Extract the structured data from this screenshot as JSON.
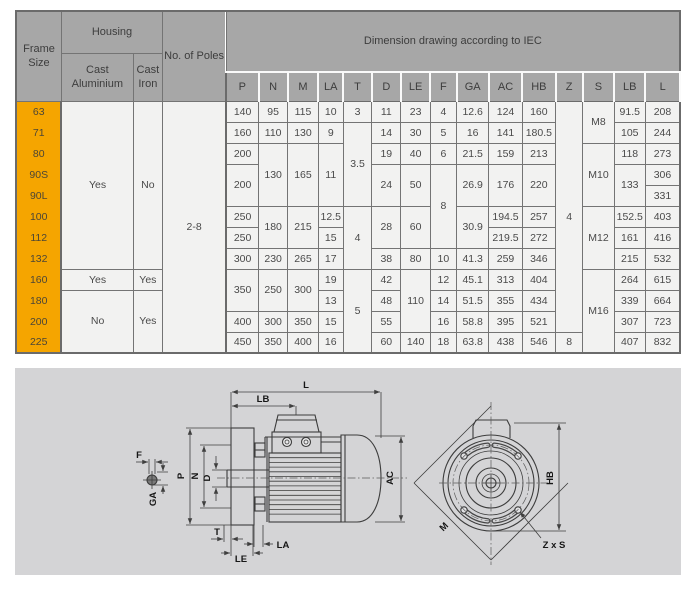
{
  "table": {
    "header": {
      "frame_size": "Frame Size",
      "housing": "Housing",
      "cast_aluminium": "Cast Aluminium",
      "cast_iron": "Cast Iron",
      "poles": "No. of Poles",
      "dimension_title": "Dimension drawing according to IEC",
      "dim_columns": [
        "P",
        "N",
        "M",
        "LA",
        "T",
        "D",
        "LE",
        "F",
        "GA",
        "AC",
        "HB",
        "Z",
        "S",
        "LB",
        "L"
      ]
    },
    "rows": [
      [
        {
          "t": "63",
          "k": "frame"
        },
        {
          "t": "Yes",
          "k": "d",
          "rs": 8
        },
        {
          "t": "No",
          "k": "d",
          "rs": 8
        },
        {
          "t": "2-8",
          "k": "d",
          "rs": 12,
          "cls": "thickr"
        },
        {
          "t": "140",
          "k": "d"
        },
        {
          "t": "95",
          "k": "d"
        },
        {
          "t": "115",
          "k": "d"
        },
        {
          "t": "10",
          "k": "d"
        },
        {
          "t": "3",
          "k": "d"
        },
        {
          "t": "11",
          "k": "d"
        },
        {
          "t": "23",
          "k": "d"
        },
        {
          "t": "4",
          "k": "d"
        },
        {
          "t": "12.6",
          "k": "d"
        },
        {
          "t": "124",
          "k": "d"
        },
        {
          "t": "160",
          "k": "d"
        },
        {
          "t": "4",
          "k": "d",
          "rs": 11
        },
        {
          "t": "M8",
          "k": "d",
          "rs": 2
        },
        {
          "t": "91.5",
          "k": "d"
        },
        {
          "t": "208",
          "k": "d"
        }
      ],
      [
        {
          "t": "71",
          "k": "frame"
        },
        {
          "t": "160",
          "k": "d"
        },
        {
          "t": "110",
          "k": "d"
        },
        {
          "t": "130",
          "k": "d"
        },
        {
          "t": "9",
          "k": "d"
        },
        {
          "t": "3.5",
          "k": "d",
          "rs": 4
        },
        {
          "t": "14",
          "k": "d"
        },
        {
          "t": "30",
          "k": "d"
        },
        {
          "t": "5",
          "k": "d"
        },
        {
          "t": "16",
          "k": "d"
        },
        {
          "t": "141",
          "k": "d"
        },
        {
          "t": "180.5",
          "k": "d"
        },
        {
          "t": "105",
          "k": "d"
        },
        {
          "t": "244",
          "k": "d"
        }
      ],
      [
        {
          "t": "80",
          "k": "frame"
        },
        {
          "t": "200",
          "k": "d"
        },
        {
          "t": "130",
          "k": "d",
          "rs": 3
        },
        {
          "t": "165",
          "k": "d",
          "rs": 3
        },
        {
          "t": "11",
          "k": "d",
          "rs": 3
        },
        {
          "t": "19",
          "k": "d"
        },
        {
          "t": "40",
          "k": "d"
        },
        {
          "t": "6",
          "k": "d"
        },
        {
          "t": "21.5",
          "k": "d"
        },
        {
          "t": "159",
          "k": "d"
        },
        {
          "t": "213",
          "k": "d"
        },
        {
          "t": "M10",
          "k": "d",
          "rs": 3
        },
        {
          "t": "118",
          "k": "d"
        },
        {
          "t": "273",
          "k": "d"
        }
      ],
      [
        {
          "t": "90S",
          "k": "frame"
        },
        {
          "t": "200",
          "k": "d",
          "rs": 2
        },
        {
          "t": "24",
          "k": "d",
          "rs": 2
        },
        {
          "t": "50",
          "k": "d",
          "rs": 2
        },
        {
          "t": "8",
          "k": "d",
          "rs": 4
        },
        {
          "t": "26.9",
          "k": "d",
          "rs": 2
        },
        {
          "t": "176",
          "k": "d",
          "rs": 2
        },
        {
          "t": "220",
          "k": "d",
          "rs": 2
        },
        {
          "t": "133",
          "k": "d",
          "rs": 2
        },
        {
          "t": "306",
          "k": "d"
        }
      ],
      [
        {
          "t": "90L",
          "k": "frame"
        },
        {
          "t": "331",
          "k": "d"
        }
      ],
      [
        {
          "t": "100",
          "k": "frame"
        },
        {
          "t": "250",
          "k": "d"
        },
        {
          "t": "180",
          "k": "d",
          "rs": 2
        },
        {
          "t": "215",
          "k": "d",
          "rs": 2
        },
        {
          "t": "12.5",
          "k": "d"
        },
        {
          "t": "4",
          "k": "d",
          "rs": 3
        },
        {
          "t": "28",
          "k": "d",
          "rs": 2
        },
        {
          "t": "60",
          "k": "d",
          "rs": 2
        },
        {
          "t": "30.9",
          "k": "d",
          "rs": 2
        },
        {
          "t": "194.5",
          "k": "d"
        },
        {
          "t": "257",
          "k": "d"
        },
        {
          "t": "M12",
          "k": "d",
          "rs": 3
        },
        {
          "t": "152.5",
          "k": "d"
        },
        {
          "t": "403",
          "k": "d"
        }
      ],
      [
        {
          "t": "112",
          "k": "frame"
        },
        {
          "t": "250",
          "k": "d"
        },
        {
          "t": "15",
          "k": "d"
        },
        {
          "t": "219.5",
          "k": "d"
        },
        {
          "t": "272",
          "k": "d"
        },
        {
          "t": "161",
          "k": "d"
        },
        {
          "t": "416",
          "k": "d"
        }
      ],
      [
        {
          "t": "132",
          "k": "frame"
        },
        {
          "t": "300",
          "k": "d"
        },
        {
          "t": "230",
          "k": "d"
        },
        {
          "t": "265",
          "k": "d"
        },
        {
          "t": "17",
          "k": "d"
        },
        {
          "t": "38",
          "k": "d"
        },
        {
          "t": "80",
          "k": "d"
        },
        {
          "t": "10",
          "k": "d"
        },
        {
          "t": "41.3",
          "k": "d"
        },
        {
          "t": "259",
          "k": "d"
        },
        {
          "t": "346",
          "k": "d"
        },
        {
          "t": "215",
          "k": "d"
        },
        {
          "t": "532",
          "k": "d"
        }
      ],
      [
        {
          "t": "160",
          "k": "frame"
        },
        {
          "t": "Yes",
          "k": "d"
        },
        {
          "t": "Yes",
          "k": "d"
        },
        {
          "t": "350",
          "k": "d",
          "rs": 2
        },
        {
          "t": "250",
          "k": "d",
          "rs": 2
        },
        {
          "t": "300",
          "k": "d",
          "rs": 2
        },
        {
          "t": "19",
          "k": "d"
        },
        {
          "t": "5",
          "k": "d",
          "rs": 4
        },
        {
          "t": "42",
          "k": "d"
        },
        {
          "t": "110",
          "k": "d",
          "rs": 3
        },
        {
          "t": "12",
          "k": "d"
        },
        {
          "t": "45.1",
          "k": "d"
        },
        {
          "t": "313",
          "k": "d"
        },
        {
          "t": "404",
          "k": "d"
        },
        {
          "t": "M16",
          "k": "d",
          "rs": 4
        },
        {
          "t": "264",
          "k": "d"
        },
        {
          "t": "615",
          "k": "d"
        }
      ],
      [
        {
          "t": "180",
          "k": "frame"
        },
        {
          "t": "No",
          "k": "d",
          "rs": 3
        },
        {
          "t": "Yes",
          "k": "d",
          "rs": 3
        },
        {
          "t": "13",
          "k": "d"
        },
        {
          "t": "48",
          "k": "d"
        },
        {
          "t": "14",
          "k": "d"
        },
        {
          "t": "51.5",
          "k": "d"
        },
        {
          "t": "355",
          "k": "d"
        },
        {
          "t": "434",
          "k": "d"
        },
        {
          "t": "339",
          "k": "d"
        },
        {
          "t": "664",
          "k": "d"
        }
      ],
      [
        {
          "t": "200",
          "k": "frame"
        },
        {
          "t": "400",
          "k": "d"
        },
        {
          "t": "300",
          "k": "d"
        },
        {
          "t": "350",
          "k": "d"
        },
        {
          "t": "15",
          "k": "d"
        },
        {
          "t": "55",
          "k": "d"
        },
        {
          "t": "16",
          "k": "d"
        },
        {
          "t": "58.8",
          "k": "d"
        },
        {
          "t": "395",
          "k": "d"
        },
        {
          "t": "521",
          "k": "d"
        },
        {
          "t": "307",
          "k": "d"
        },
        {
          "t": "723",
          "k": "d"
        }
      ],
      [
        {
          "t": "225",
          "k": "frame"
        },
        {
          "t": "450",
          "k": "d"
        },
        {
          "t": "350",
          "k": "d"
        },
        {
          "t": "400",
          "k": "d"
        },
        {
          "t": "16",
          "k": "d"
        },
        {
          "t": "60",
          "k": "d"
        },
        {
          "t": "140",
          "k": "d"
        },
        {
          "t": "18",
          "k": "d"
        },
        {
          "t": "63.8",
          "k": "d"
        },
        {
          "t": "438",
          "k": "d"
        },
        {
          "t": "546",
          "k": "d"
        },
        {
          "t": "8",
          "k": "d"
        },
        {
          "t": "407",
          "k": "d"
        },
        {
          "t": "832",
          "k": "d"
        }
      ]
    ]
  },
  "drawing": {
    "labels": {
      "l": "L",
      "lb": "LB",
      "ac": "AC",
      "p": "P",
      "n": "N",
      "d": "D",
      "f": "F",
      "ga": "GA",
      "t": "T",
      "la": "LA",
      "le": "LE",
      "m": "M",
      "hb": "HB",
      "zxs": "Z x S"
    }
  },
  "colors": {
    "frame_orange": "#f5a500",
    "header_gray": "#a7a7a7",
    "cell_bg": "#f2f2f1",
    "panel_bg": "#d4d4d6"
  },
  "chart_data": {
    "type": "table",
    "title": "Dimension drawing according to IEC",
    "columns": [
      "Frame Size",
      "Cast Aluminium",
      "Cast Iron",
      "No. of Poles",
      "P",
      "N",
      "M",
      "LA",
      "T",
      "D",
      "LE",
      "F",
      "GA",
      "AC",
      "HB",
      "Z",
      "S",
      "LB",
      "L"
    ],
    "rows": [
      [
        "63",
        "Yes",
        "No",
        "2-8",
        140,
        95,
        115,
        10,
        3,
        11,
        23,
        4,
        12.6,
        124,
        160,
        4,
        "M8",
        91.5,
        208
      ],
      [
        "71",
        "Yes",
        "No",
        "2-8",
        160,
        110,
        130,
        9,
        3.5,
        14,
        30,
        5,
        16,
        141,
        180.5,
        4,
        "M8",
        105,
        244
      ],
      [
        "80",
        "Yes",
        "No",
        "2-8",
        200,
        130,
        165,
        11,
        3.5,
        19,
        40,
        6,
        21.5,
        159,
        213,
        4,
        "M10",
        118,
        273
      ],
      [
        "90S",
        "Yes",
        "No",
        "2-8",
        200,
        130,
        165,
        11,
        3.5,
        24,
        50,
        8,
        26.9,
        176,
        220,
        4,
        "M10",
        133,
        306
      ],
      [
        "90L",
        "Yes",
        "No",
        "2-8",
        200,
        130,
        165,
        11,
        3.5,
        24,
        50,
        8,
        26.9,
        176,
        220,
        4,
        "M10",
        133,
        331
      ],
      [
        "100",
        "Yes",
        "No",
        "2-8",
        250,
        180,
        215,
        12.5,
        4,
        28,
        60,
        8,
        30.9,
        194.5,
        257,
        4,
        "M12",
        152.5,
        403
      ],
      [
        "112",
        "Yes",
        "No",
        "2-8",
        250,
        180,
        215,
        15,
        4,
        28,
        60,
        8,
        30.9,
        219.5,
        272,
        4,
        "M12",
        161,
        416
      ],
      [
        "132",
        "Yes",
        "No",
        "2-8",
        300,
        230,
        265,
        17,
        4,
        38,
        80,
        10,
        41.3,
        259,
        346,
        4,
        "M12",
        215,
        532
      ],
      [
        "160",
        "Yes",
        "Yes",
        "2-8",
        350,
        250,
        300,
        19,
        5,
        42,
        110,
        12,
        45.1,
        313,
        404,
        4,
        "M16",
        264,
        615
      ],
      [
        "180",
        "No",
        "Yes",
        "2-8",
        350,
        250,
        300,
        13,
        5,
        48,
        110,
        14,
        51.5,
        355,
        434,
        4,
        "M16",
        339,
        664
      ],
      [
        "200",
        "No",
        "Yes",
        "2-8",
        400,
        300,
        350,
        15,
        5,
        55,
        110,
        16,
        58.8,
        395,
        521,
        4,
        "M16",
        307,
        723
      ],
      [
        "225",
        "No",
        "Yes",
        "2-8",
        450,
        350,
        400,
        16,
        5,
        60,
        140,
        18,
        63.8,
        438,
        546,
        8,
        "M16",
        407,
        832
      ]
    ]
  }
}
